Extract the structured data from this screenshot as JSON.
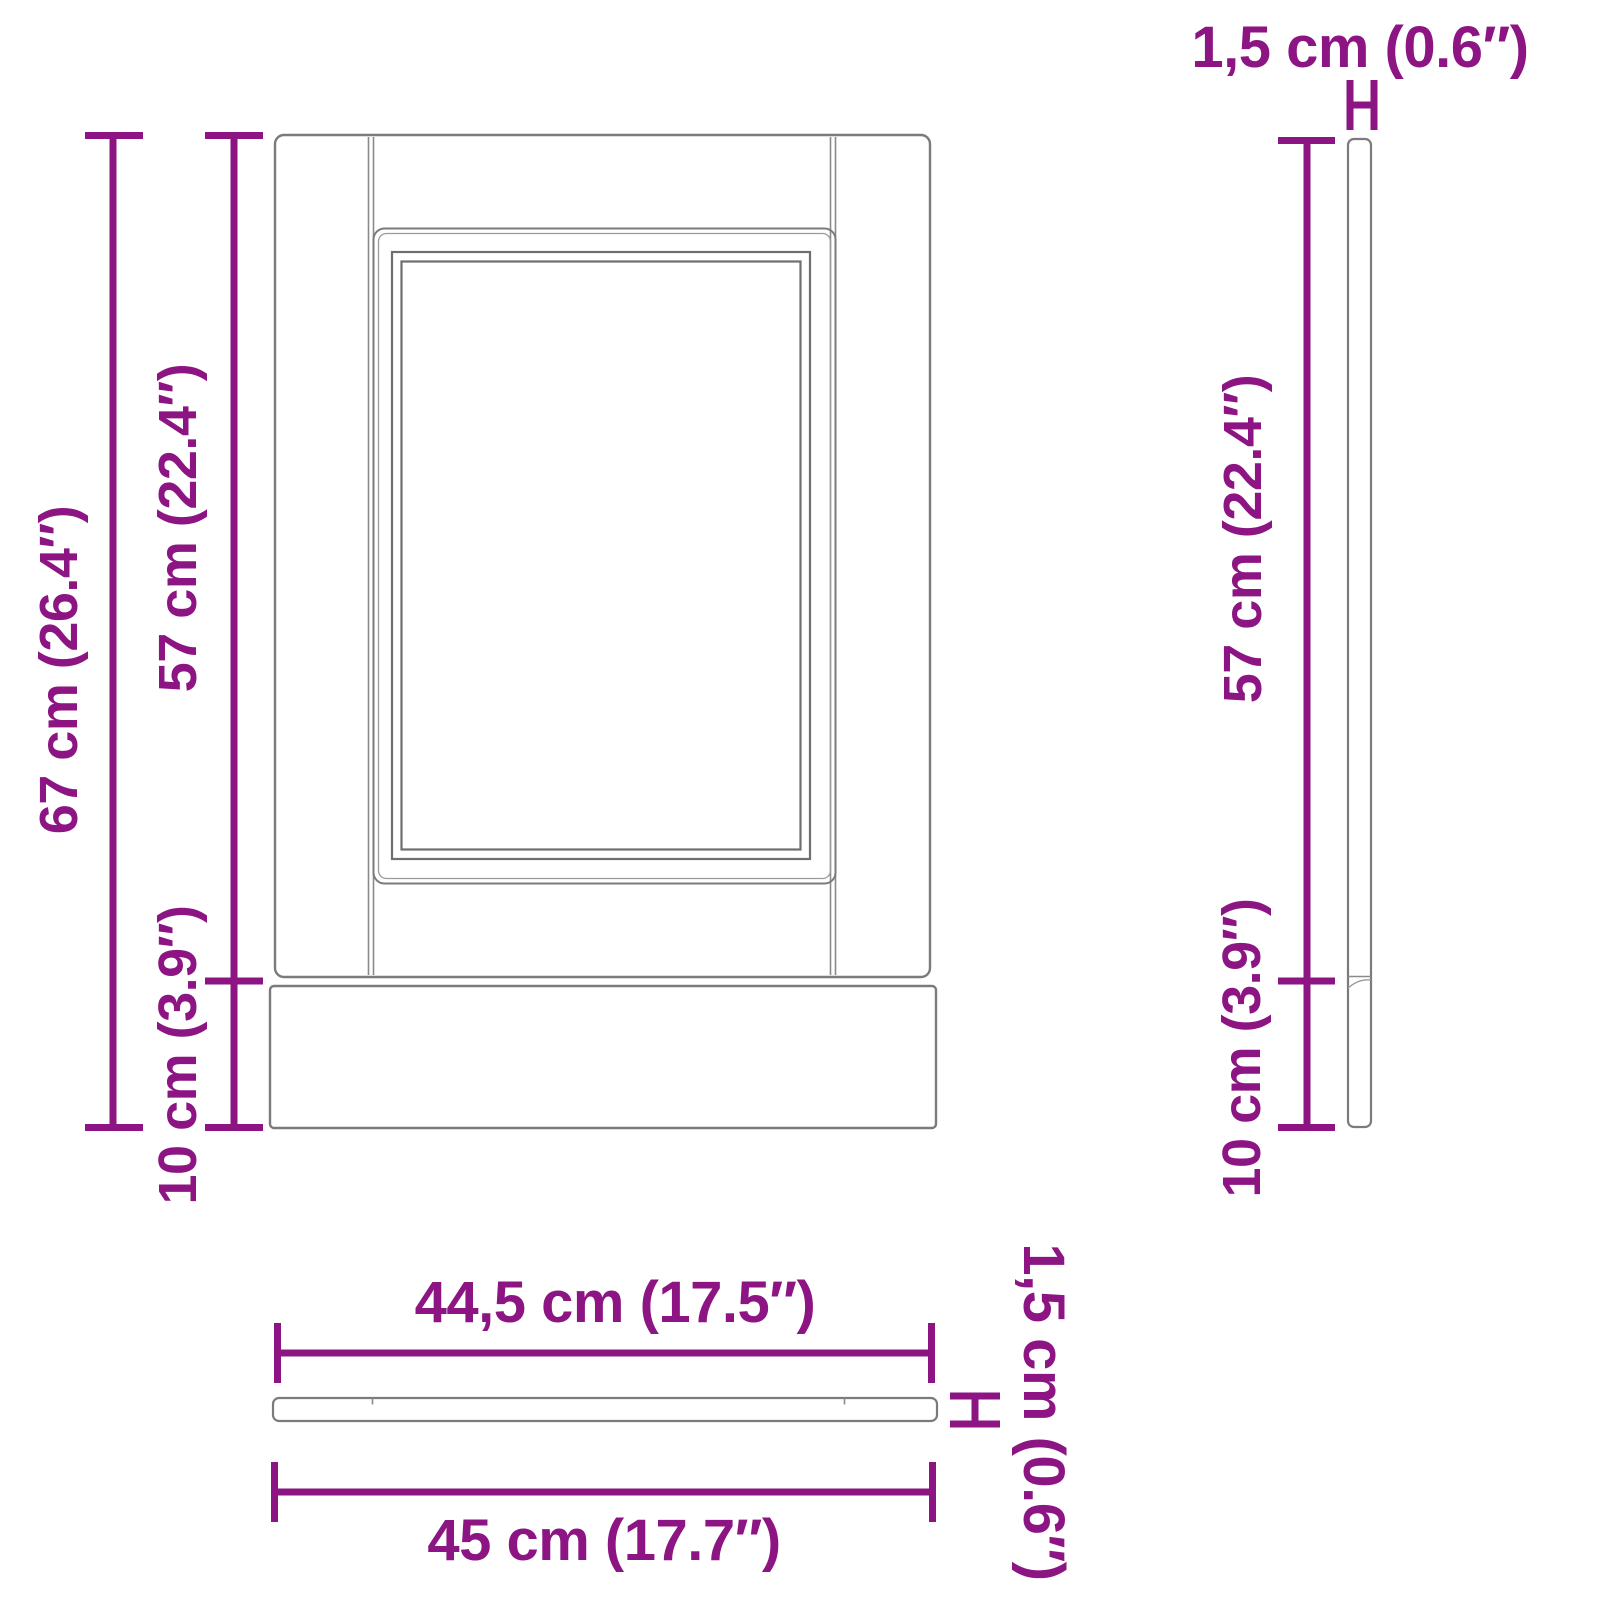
{
  "page": {
    "background": "#ffffff"
  },
  "colors": {
    "dimension": "#8C1583",
    "outline": "#7b7b7b",
    "outline_dark": "#6f6f6f",
    "outline_light": "#9a9a9a"
  },
  "diagram": {
    "type": "furniture-dimension-drawing",
    "subject": "cabinet panel with plinth, front / side / bottom views",
    "views": {
      "front": {
        "labels": {
          "total_height": "67 cm (26.4″)",
          "door_height": "57 cm (22.4″)",
          "plinth_height": "10 cm (3.9″)"
        }
      },
      "side": {
        "labels": {
          "thickness": "1,5 cm (0.6″)",
          "door_height": "57 cm (22.4″)",
          "plinth_height": "10 cm (3.9″)"
        }
      },
      "bottom": {
        "labels": {
          "door_width": "44,5 cm (17.5″)",
          "total_width": "45 cm (17.7″)",
          "thickness": "1,5 cm (0.6″)"
        }
      }
    }
  }
}
